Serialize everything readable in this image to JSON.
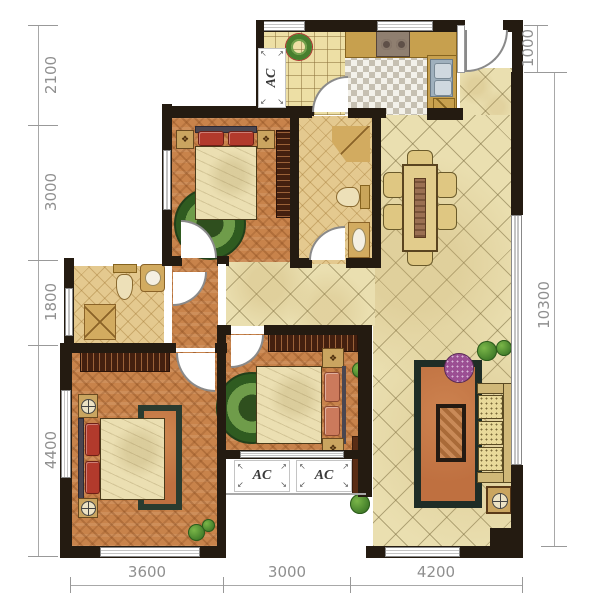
{
  "plan": {
    "ac_label": "AC"
  },
  "dimensions": {
    "left": [
      "2100",
      "3000",
      "1800",
      "4400"
    ],
    "right": [
      "1000",
      "10300"
    ],
    "bottom": [
      "3600",
      "3000",
      "4200"
    ]
  },
  "icons": {
    "ornament": "❖",
    "arrow_tl": "↖",
    "arrow_tr": "↗",
    "arrow_bl": "↙",
    "arrow_br": "↘"
  },
  "colors": {
    "wall": "#241b11",
    "wood_floor": "#c8834b",
    "tile_floor": "#eadfb0",
    "bath_floor": "#e4c98f",
    "counter_tan": "#c7a04e",
    "rug_green": "#3f6b2a",
    "rug_orange": "#bf7040",
    "pillow_red": "#b23a2c",
    "dimension_text": "#8f8f8f"
  }
}
